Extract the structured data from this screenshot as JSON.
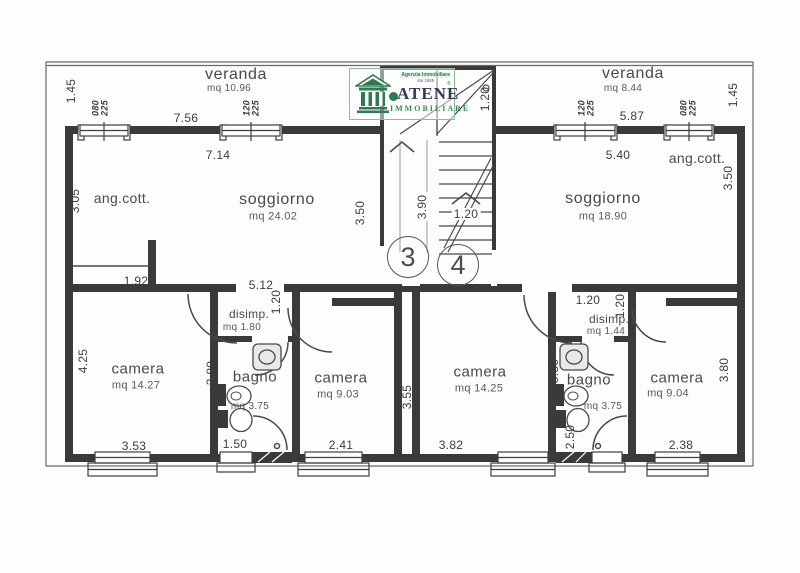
{
  "logo": {
    "brand": "ATENE",
    "reg": "®",
    "subtitle": "IMMOBILIARE",
    "tagline1": "Agenzia Immobiliare",
    "tagline2": "dal 1965",
    "green": "#3c8a5c",
    "navy": "#333a55"
  },
  "units": {
    "left": "3",
    "right": "4"
  },
  "rooms": {
    "veranda_left": {
      "name": "veranda",
      "area": "mq 10.96"
    },
    "veranda_right": {
      "name": "veranda",
      "area": "mq 8.44"
    },
    "soggiorno_left": {
      "name": "soggiorno",
      "area": "mq 24.02"
    },
    "soggiorno_right": {
      "name": "soggiorno",
      "area": "mq 18.90"
    },
    "angcott_left": {
      "name": "ang.cott."
    },
    "angcott_right": {
      "name": "ang.cott."
    },
    "camera_left_large": {
      "name": "camera",
      "area": "mq 14.27"
    },
    "camera_left_small": {
      "name": "camera",
      "area": "mq 9.03"
    },
    "camera_right_large": {
      "name": "camera",
      "area": "mq 14.25"
    },
    "camera_right_small": {
      "name": "camera",
      "area": "mq 9.04"
    },
    "bagno_left": {
      "name": "bagno",
      "area": "mq 3.75"
    },
    "bagno_right": {
      "name": "bagno",
      "area": "mq 3.75"
    },
    "disimp_left": {
      "name": "disimp.",
      "area": "mq 1.80"
    },
    "disimp_right": {
      "name": "disimp.",
      "area": "mq 1.44"
    }
  },
  "window_labels": {
    "w080": "080\n225",
    "w120": "120\n225"
  },
  "dims": {
    "v120": "1.20",
    "v145": "1.45",
    "v150": "1.50",
    "v192": "1.92",
    "v238": "2.38",
    "v241": "2.41",
    "v250": "2.50",
    "v305": "3.05",
    "v350": "3.50",
    "v353": "3.53",
    "v355": "3.55",
    "v380": "3.80",
    "v382": "3.82",
    "v390": "3.90",
    "v425": "4.25",
    "v512": "5.12",
    "v540": "5.40",
    "v587": "5.87",
    "v714": "7.14",
    "v756": "7.56"
  }
}
